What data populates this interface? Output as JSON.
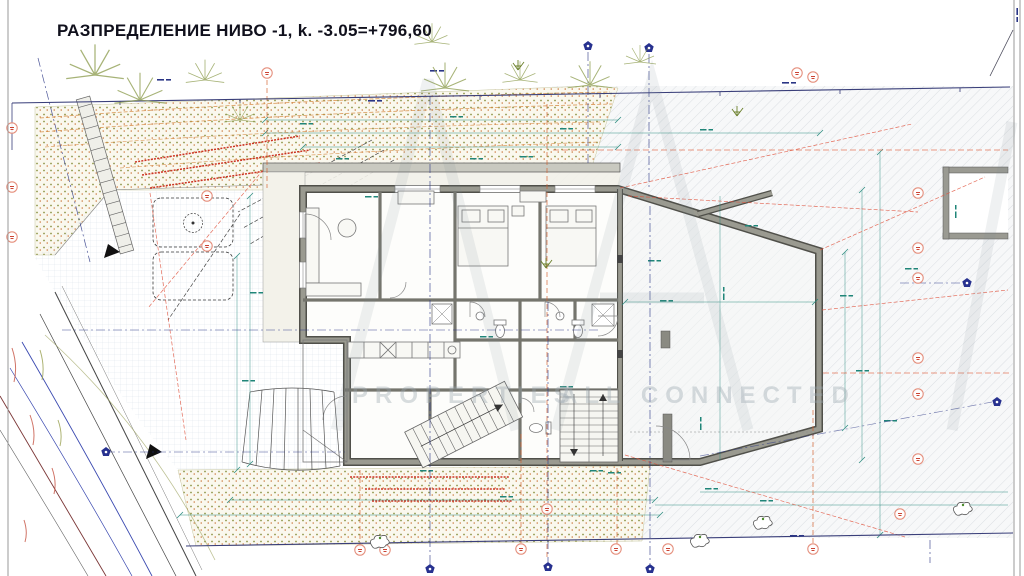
{
  "title": "РАЗПРЕДЕЛЕНИЕ НИВО -1, k. -3.05=+796,60",
  "watermark": {
    "left": "PROPERTIES",
    "right": "ALL CONNECTED"
  },
  "colors": {
    "dimension_teal": "#1f8578",
    "annotation_red": "#cc3322",
    "axis_navy": "#2a3585",
    "boundary_navy": "#3a3f7a",
    "wall_gray": "#9a9a90",
    "terrain_dot_olive": "#8f9548",
    "terrain_dot_orange": "#c8763a",
    "contour_orange": "#d4873c",
    "road_blue": "#3a49b0",
    "road_maroon": "#7a3535"
  }
}
